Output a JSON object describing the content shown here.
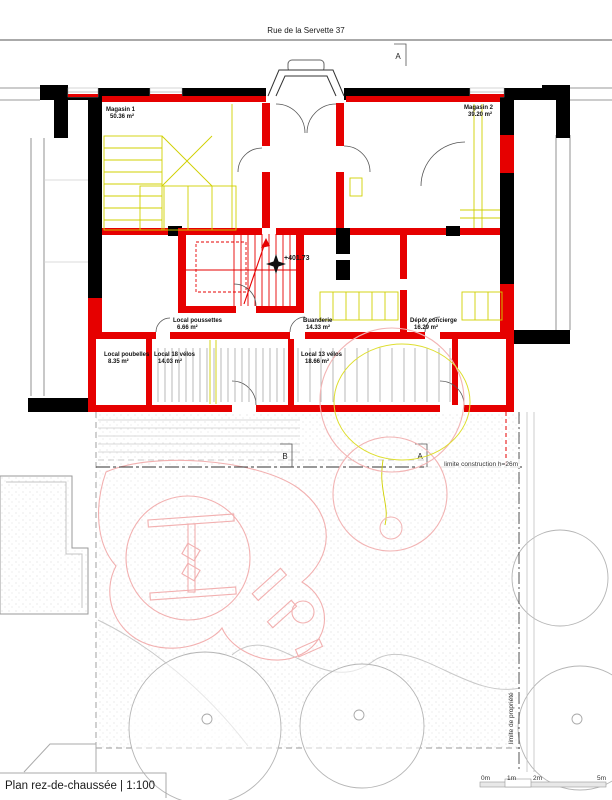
{
  "page": {
    "street_label": "Rue de la Servette 37",
    "drawing_title": "Plan rez-de-chaussée | 1:100"
  },
  "markers": {
    "section_top": "A",
    "section_garden_left": "B",
    "section_garden_right": "A",
    "level": "+401.73"
  },
  "rooms": [
    {
      "name": "Magasin 1",
      "area": "50.36 m²"
    },
    {
      "name": "Magasin 2",
      "area": "39.20 m²"
    },
    {
      "name": "Local poussettes",
      "area": "6.66 m²"
    },
    {
      "name": "Buanderie",
      "area": "14.33 m²"
    },
    {
      "name": "Dépôt concierge",
      "area": "16.29 m²"
    },
    {
      "name": "Local poubelles",
      "area": "8.35 m²"
    },
    {
      "name": "Local 18 vélos",
      "area": "14.03 m²"
    },
    {
      "name": "Local 13 vélos",
      "area": "18.66 m²"
    }
  ],
  "site": {
    "construction_limit": "limite construction h=26m",
    "property_limit": "limite de propriété"
  },
  "scale_bar": {
    "labels": [
      "0m",
      "1m",
      "2m",
      "5m"
    ]
  },
  "colors": {
    "new_wall": "#e60000",
    "existing_wall": "#000000",
    "demolition": "#d0d000",
    "landscape_pink": "#f2b4b4"
  }
}
